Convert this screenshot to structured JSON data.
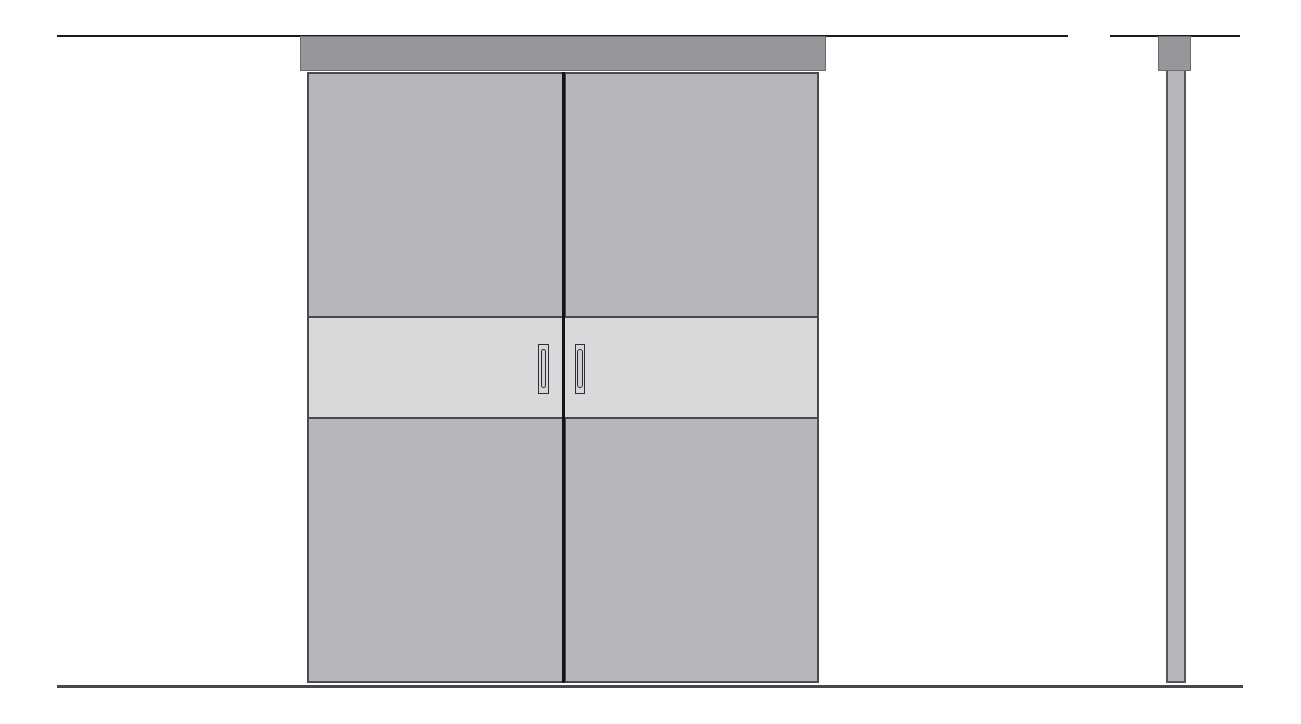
{
  "colors": {
    "background": "#ffffff",
    "ceiling_line": "#1c1c1c",
    "floor_line": "#47474b",
    "track_fill": "#97979b",
    "track_border": "#6a6a6f",
    "door_fill": "#b6b7bb",
    "door_border": "#4b4b4f",
    "band_fill": "#d8d9da",
    "band_border": "#4a4a4e",
    "seam": "#141414",
    "handle_fill": "#d6d7d9",
    "handle_border": "#2e2e32",
    "handle_pill_fill": "#cfd0d3",
    "side_panel_fill": "#b7b8bc",
    "side_panel_border": "#55555a"
  },
  "drawing": {
    "views": [
      {
        "id": "front-elevation",
        "parts": [
          "track-header",
          "left-door-panel",
          "right-door-panel",
          "glass-band",
          "door-seam",
          "left-door-handle",
          "right-door-handle"
        ]
      },
      {
        "id": "side-elevation",
        "parts": [
          "track-header",
          "door-panel-profile"
        ]
      }
    ],
    "reference_lines": [
      "ceiling-line-left",
      "ceiling-line-right",
      "floor-line"
    ]
  }
}
